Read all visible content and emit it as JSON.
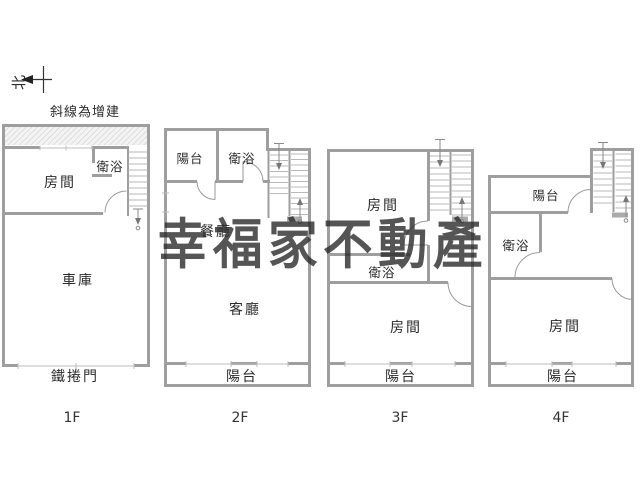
{
  "compass": {
    "label": "北"
  },
  "note": "斜線為增建",
  "watermark": "幸福家不動產",
  "floors": [
    {
      "name": "1F",
      "labels": {
        "bath": "衛浴",
        "room": "房間",
        "garage": "車庫",
        "roller_door": "鐵捲門"
      }
    },
    {
      "name": "2F",
      "labels": {
        "balcony_top": "陽台",
        "bath": "衛浴",
        "dining": "餐廳",
        "living": "客廳",
        "balcony_bottom": "陽台"
      }
    },
    {
      "name": "3F",
      "labels": {
        "room_top": "房間",
        "bath": "衛浴",
        "room_bottom": "房間",
        "balcony_bottom": "陽台"
      }
    },
    {
      "name": "4F",
      "labels": {
        "balcony_top": "陽台",
        "bath": "衛浴",
        "room": "房間",
        "balcony_bottom": "陽台"
      }
    }
  ],
  "colors": {
    "wall": "#9e9e9e",
    "thin_line": "#bcbcbc",
    "text": "#2b2b2b",
    "watermark": "#8c8c8c",
    "hatch": "#c9c9c9",
    "background": "#ffffff"
  }
}
